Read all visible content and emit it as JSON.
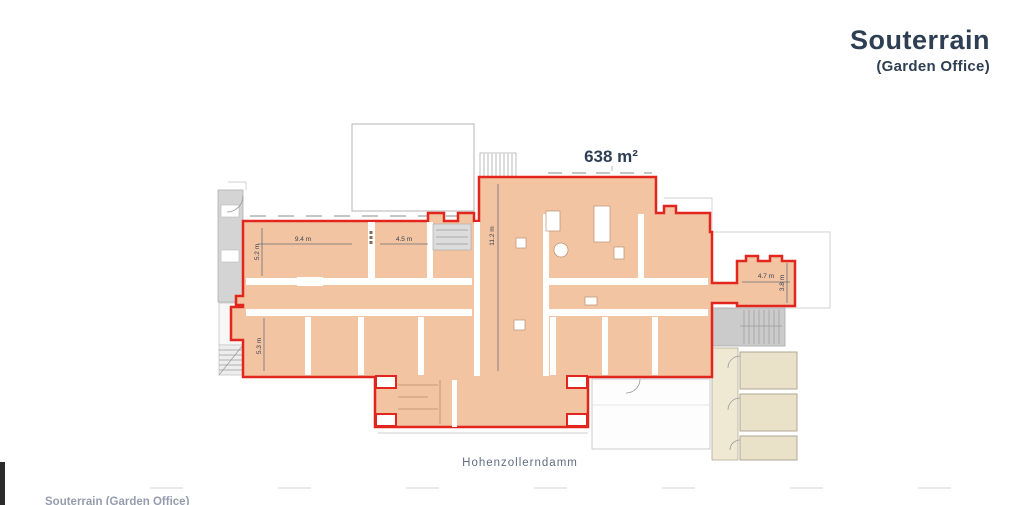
{
  "title": {
    "main": "Souterrain",
    "subtitle": "(Garden Office)"
  },
  "plan": {
    "area_label": "638 m²",
    "street_label": "Hohenzollerndamm",
    "dimensions": [
      {
        "label": "9.4 m"
      },
      {
        "label": "4.5 m"
      },
      {
        "label": "5.2 m"
      },
      {
        "label": "11.2 m"
      },
      {
        "label": "4.7 m"
      },
      {
        "label": "3.8 m"
      },
      {
        "label": "5.3 m"
      }
    ]
  },
  "footer": {
    "partial_text": "Souterrain (Garden Office)"
  },
  "colors": {
    "accent_red": "#E3261D",
    "highlight_fill": "#F2C4A2",
    "title_navy": "#2E3F54"
  }
}
